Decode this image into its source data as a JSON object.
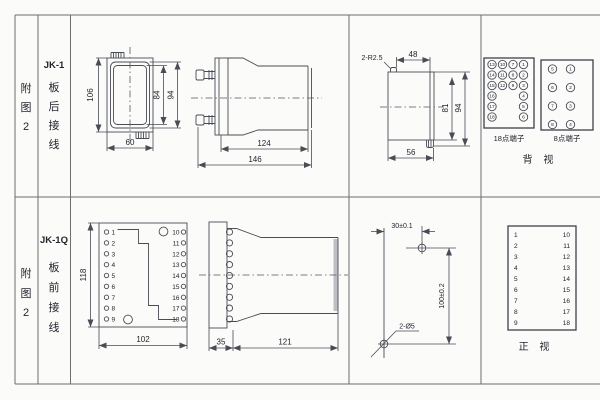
{
  "colors": {
    "line": "#4a4c55",
    "text": "#23252e",
    "grid": "#6e6e6e",
    "background": "#fbfbfa"
  },
  "row1": {
    "fig": [
      "附",
      "图",
      "2"
    ],
    "model": "JK-1",
    "wiring": [
      "板",
      "后",
      "接",
      "线"
    ]
  },
  "row2": {
    "fig": [
      "附",
      "图",
      "2"
    ],
    "model": "JK-1Q",
    "wiring": [
      "板",
      "前",
      "接",
      "线"
    ]
  },
  "fig_front": {
    "height": "106",
    "inner": "84",
    "outer": "94",
    "width": "60"
  },
  "fig_side": {
    "body": "124",
    "total": "146"
  },
  "fig_cutout": {
    "radius_label": "2-R2.5",
    "top": "48",
    "inner": "81",
    "outer": "94",
    "bottom": "56"
  },
  "fig_q_front": {
    "height": "118",
    "width": "102",
    "left": [
      "1",
      "2",
      "3",
      "4",
      "5",
      "6",
      "7",
      "8",
      "9"
    ],
    "right": [
      "10",
      "11",
      "12",
      "13",
      "14",
      "15",
      "16",
      "17",
      "18"
    ]
  },
  "fig_q_side": {
    "plate": "35",
    "body": "121"
  },
  "fig_drill": {
    "h": "30±0.1",
    "v": "100±0.2",
    "holes": "2-Ø5"
  },
  "rear": {
    "t18": {
      "caption": "18点端子",
      "col1": [
        "13",
        "14",
        "15",
        "16",
        "17",
        "18"
      ],
      "col2": [
        "10",
        "11",
        "12"
      ],
      "col3": [
        "7",
        "8",
        "9"
      ],
      "col4": [
        "1",
        "2",
        "3",
        "4",
        "5",
        "6"
      ]
    },
    "t8": {
      "caption": "8点端子",
      "left": [
        "5",
        "6",
        "7",
        "8"
      ],
      "right": [
        "1",
        "2",
        "3",
        "4"
      ]
    },
    "label": "背 视"
  },
  "front": {
    "left": [
      "1",
      "2",
      "3",
      "4",
      "5",
      "6",
      "7",
      "8",
      "9"
    ],
    "right": [
      "10",
      "11",
      "12",
      "13",
      "14",
      "15",
      "16",
      "17",
      "18"
    ],
    "label": "正 视"
  }
}
